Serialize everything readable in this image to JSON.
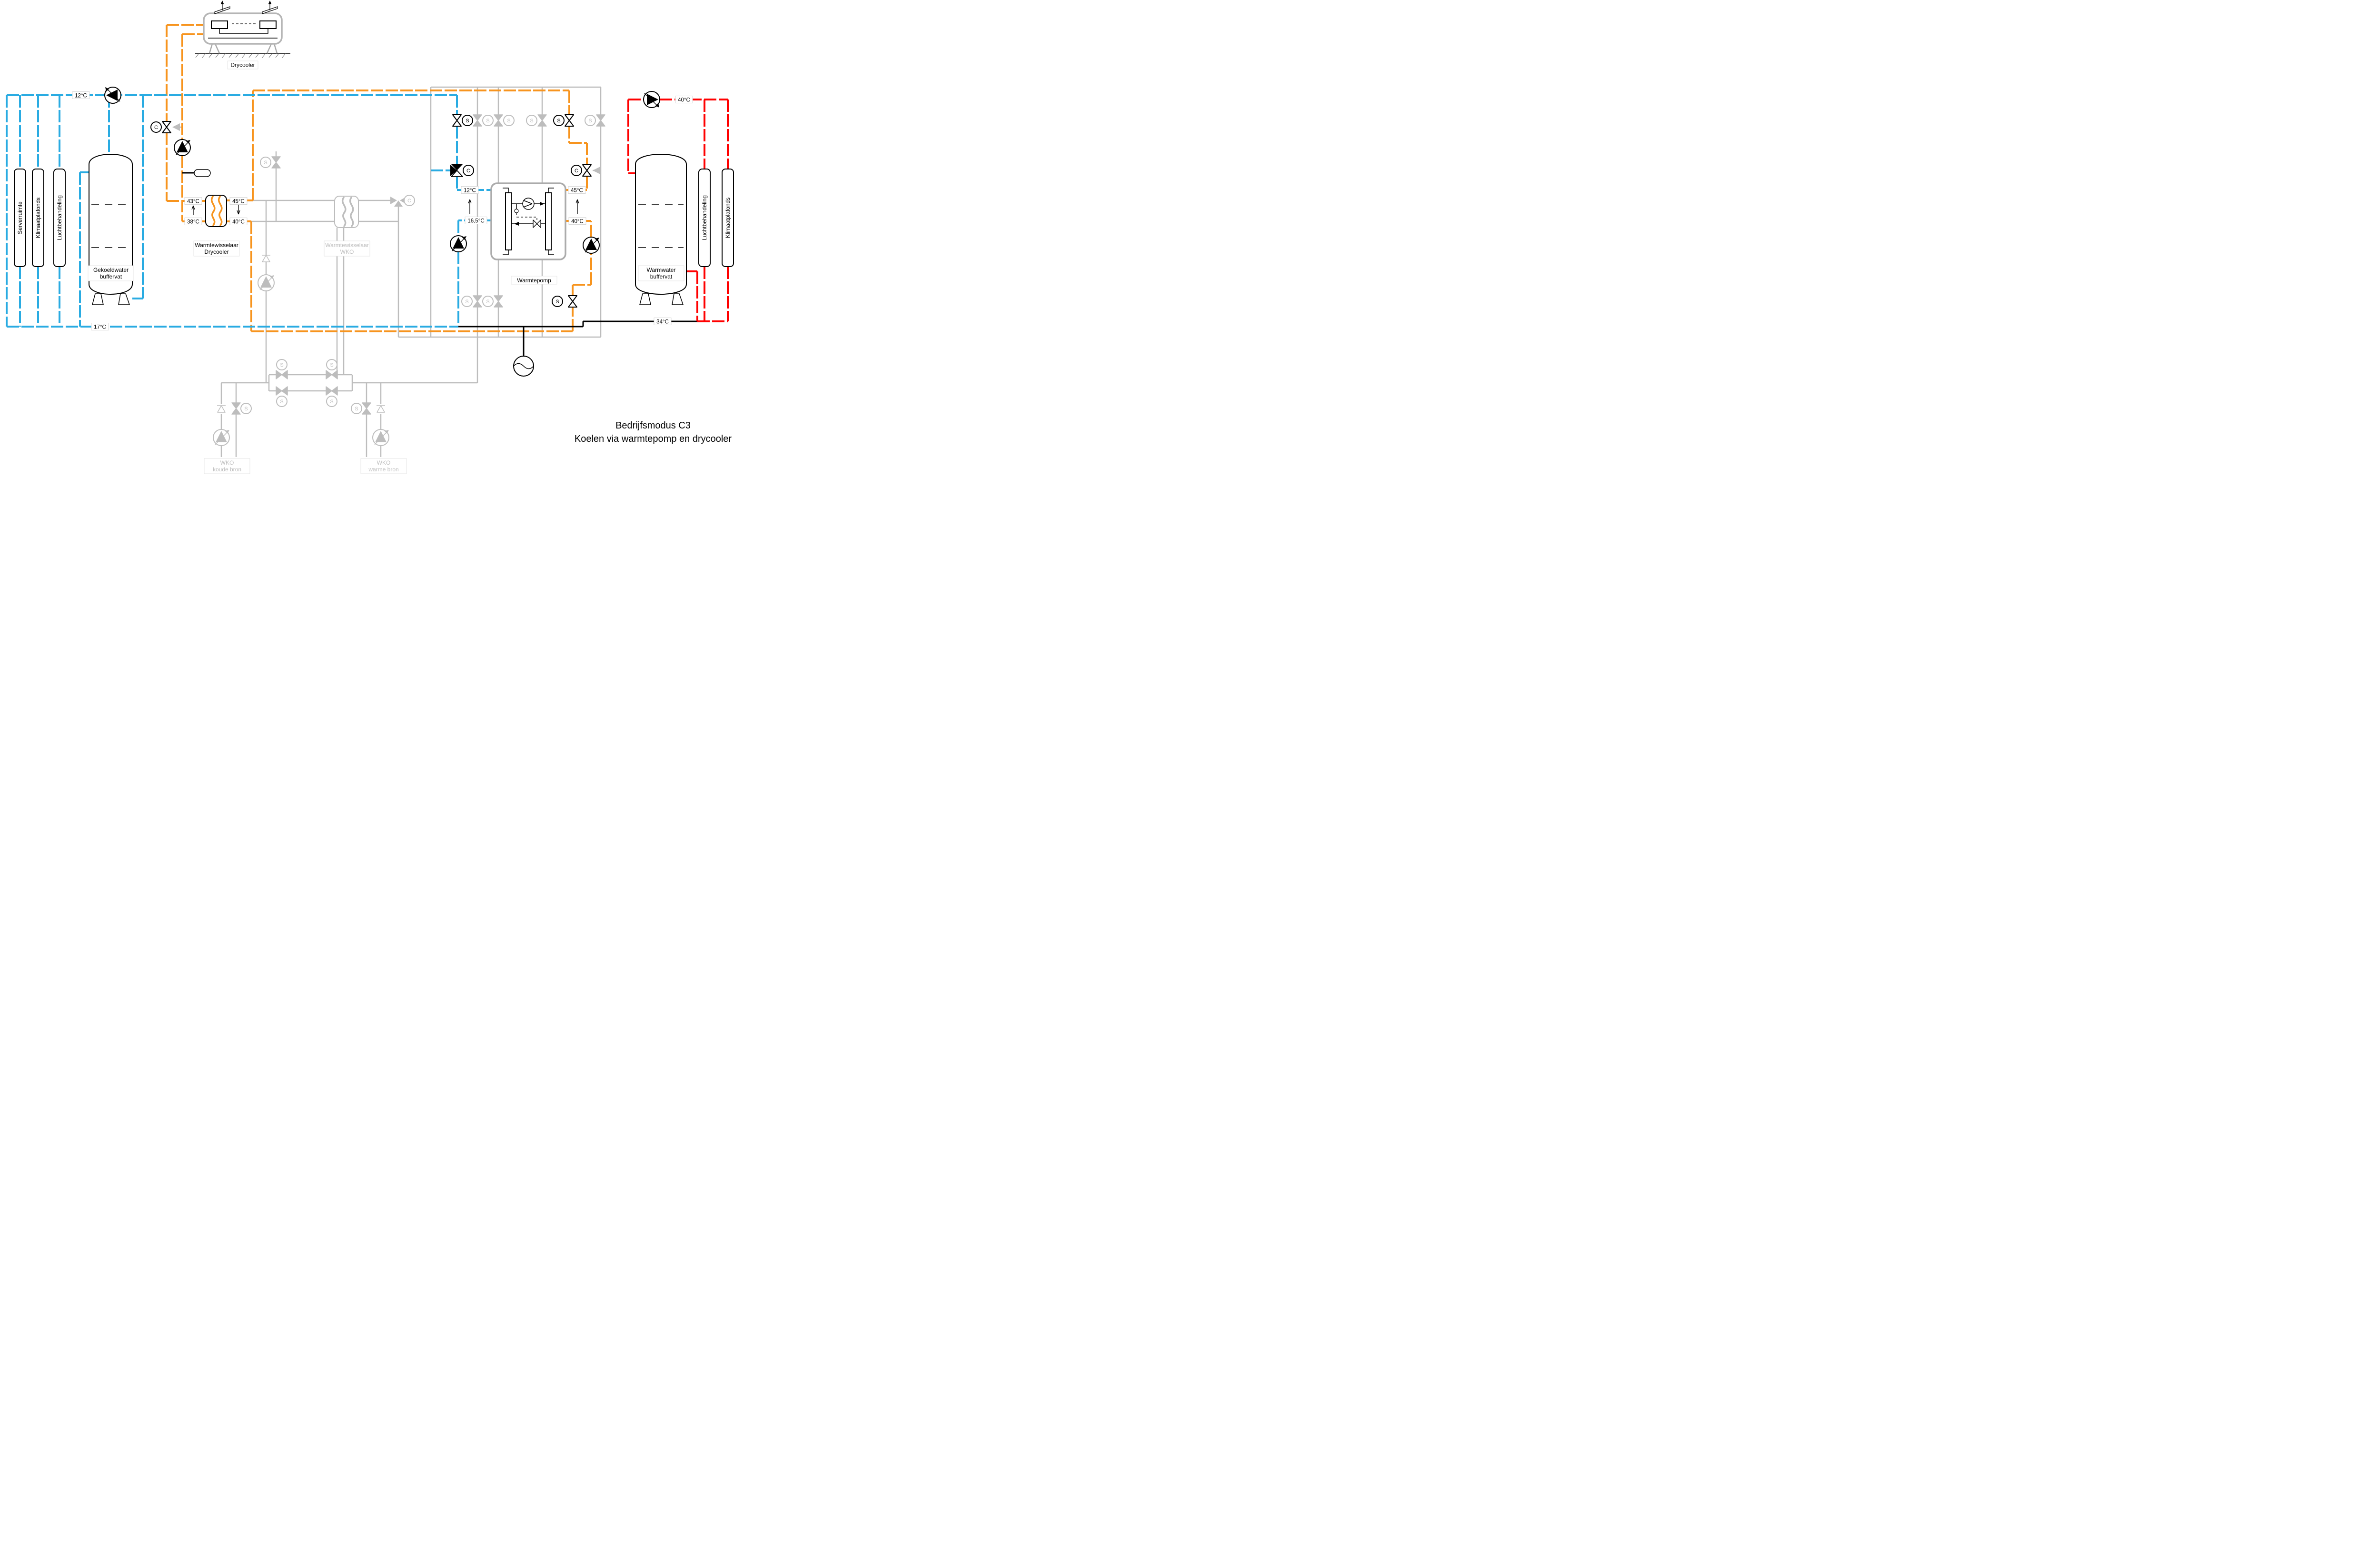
{
  "title": {
    "line1": "Bedrijfsmodus  C3",
    "line2": "Koelen via warmtepomp en drycooler"
  },
  "colors": {
    "cold_pipe": "#29ABE2",
    "drycooler_loop_pipe": "#F7941E",
    "hot_pipe": "#FF0000",
    "inactive_pipe": "#BDBDBD",
    "common_pipe": "#000000"
  },
  "components": {
    "drycooler": {
      "label": "Drycooler"
    },
    "hx_drycooler": {
      "label_line1": "Warmtewisselaar",
      "label_line2": "Drycooler"
    },
    "hx_wko": {
      "label_line1": "Warmtewisselaar",
      "label_line2": "WKO"
    },
    "heat_pump": {
      "label": "Warmtepomp"
    },
    "cold_buffer": {
      "label_line1": "Gekoeldwater",
      "label_line2": "buffervat"
    },
    "warm_buffer": {
      "label_line1": "Warmwater",
      "label_line2": "buffervat"
    },
    "wko_cold_well": {
      "label_line1": "WKO",
      "label_line2": "koude bron"
    },
    "wko_warm_well": {
      "label_line1": "WKO",
      "label_line2": "warme bron"
    },
    "loads_left": [
      "Serverruimte",
      "Klimaatplafonds",
      "Luchtbehandeling"
    ],
    "loads_right": [
      "Luchtbehandeling",
      "Klimaatplafonds"
    ]
  },
  "temperatures": {
    "cold_supply": "12°C",
    "cold_return": "17°C",
    "hx_dc_left_top": "43°C",
    "hx_dc_left_bottom": "38°C",
    "hx_dc_right_top": "45°C",
    "hx_dc_right_bottom": "40°C",
    "hp_evap_in": "12°C",
    "hp_evap_out": "16,5°C",
    "hp_cond_out": "45°C",
    "hp_cond_in": "40°C",
    "hot_supply": "40°C",
    "hot_return": "34°C"
  },
  "actuators": {
    "solenoid": "S",
    "control": "C"
  }
}
